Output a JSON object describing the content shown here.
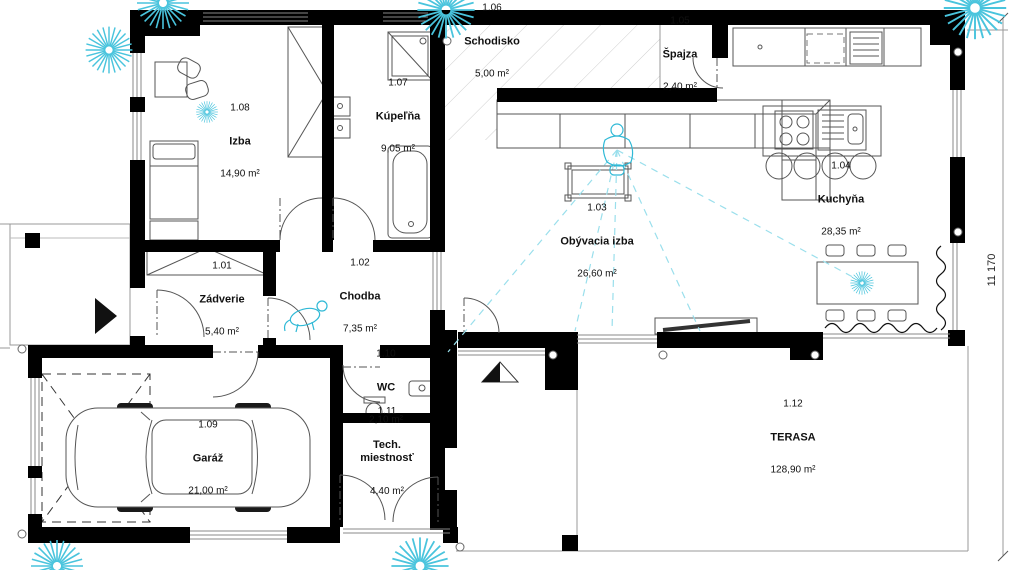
{
  "plan": {
    "title": "Floor plan - ground floor",
    "dimension_right": "11 170",
    "accent_color": "#49c4dd",
    "wall_color": "#000000",
    "rooms": [
      {
        "id": "1.01",
        "name": "Zádverie",
        "area": "5,40 m²",
        "x": 222,
        "y": 300
      },
      {
        "id": "1.02",
        "name": "Chodba",
        "area": "7,35 m²",
        "x": 360,
        "y": 297
      },
      {
        "id": "1.03",
        "name": "Obývacia izba",
        "area": "26,60 m²",
        "x": 597,
        "y": 242
      },
      {
        "id": "1.04",
        "name": "Kuchyňa",
        "area": "28,35 m²",
        "x": 841,
        "y": 200
      },
      {
        "id": "1.05",
        "name": "Špajza",
        "area": "2,40 m²",
        "x": 680,
        "y": 55
      },
      {
        "id": "1.06",
        "name": "Schodisko",
        "area": "5,00 m²",
        "x": 492,
        "y": 42
      },
      {
        "id": "1.07",
        "name": "Kúpeľňa",
        "area": "9,05 m²",
        "x": 398,
        "y": 117
      },
      {
        "id": "1.08",
        "name": "Izba",
        "area": "14,90 m²",
        "x": 240,
        "y": 142
      },
      {
        "id": "1.09",
        "name": "Garáž",
        "area": "21,00 m²",
        "x": 208,
        "y": 459
      },
      {
        "id": "1.10",
        "name": "WC",
        "area": "2,10 m²",
        "x": 386,
        "y": 388
      },
      {
        "id": "1.11",
        "name": "Tech.\nmiestnosť",
        "area": "4,40 m²",
        "x": 387,
        "y": 452
      },
      {
        "id": "1.12",
        "name": "TERASA",
        "area": "128,90 m²",
        "x": 793,
        "y": 438
      }
    ]
  }
}
